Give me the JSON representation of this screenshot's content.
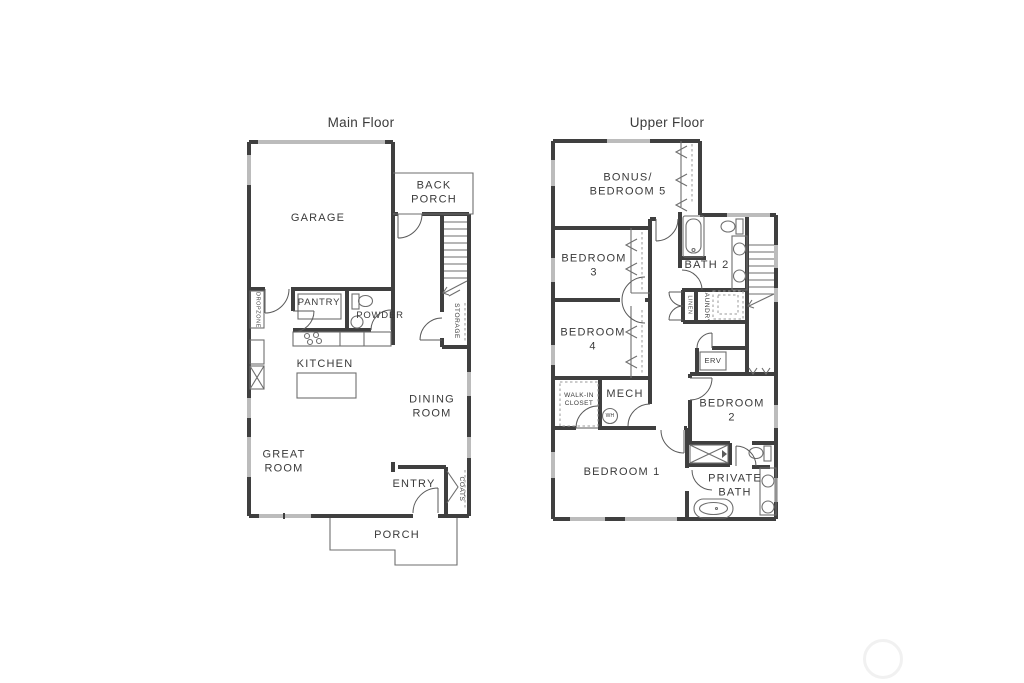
{
  "colors": {
    "background": "#ffffff",
    "wall": "#3f3f3f",
    "window": "#bcbcbc",
    "fixture_line": "#6e6e6e",
    "text": "#3a3a3a",
    "watermark": "#f1f1f1"
  },
  "main_floor": {
    "title": "Main Floor",
    "labels": {
      "garage": "GARAGE",
      "back_porch": "BACK\nPORCH",
      "pantry": "PANTRY",
      "powder": "POWDER",
      "dropzone": "DROPZONE",
      "kitchen": "KITCHEN",
      "dining_room": "DINING\nROOM",
      "great_room": "GREAT\nROOM",
      "entry": "ENTRY",
      "coats": "COATS",
      "storage": "STORAGE",
      "porch": "PORCH"
    }
  },
  "upper_floor": {
    "title": "Upper Floor",
    "labels": {
      "bonus_bedroom5": "BONUS/\nBEDROOM 5",
      "bedroom3": "BEDROOM\n3",
      "bath2": "BATH 2",
      "linen": "LINEN",
      "laundry": "LAUNDRY",
      "bedroom4": "BEDROOM\n4",
      "erv": "ERV",
      "walk_in_closet": "WALK-IN\nCLOSET",
      "mech": "MECH",
      "water_heater": "WH",
      "bedroom2": "BEDROOM\n2",
      "bedroom1": "BEDROOM 1",
      "private_bath": "PRIVATE\nBATH"
    }
  }
}
